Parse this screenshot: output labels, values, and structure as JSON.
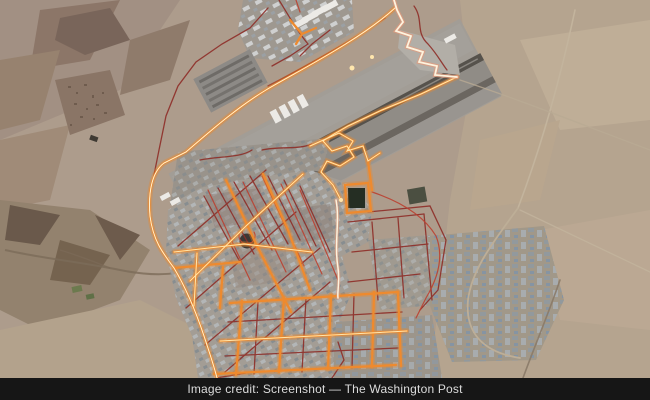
{
  "caption": {
    "text": "Image credit: Screenshot — The Washington Post"
  },
  "map": {
    "colors": {
      "terrain": "#ad9c8c",
      "trace_maroon": "#8e2e28",
      "trace_red": "#bb4030",
      "trace_orange": "#ee8a2e",
      "trace_yellow": "#ffe6ad",
      "trace_white": "#fdf3de",
      "runway": "#56524c",
      "caption_bg": "#161616",
      "caption_text": "#dcdcdc"
    }
  }
}
